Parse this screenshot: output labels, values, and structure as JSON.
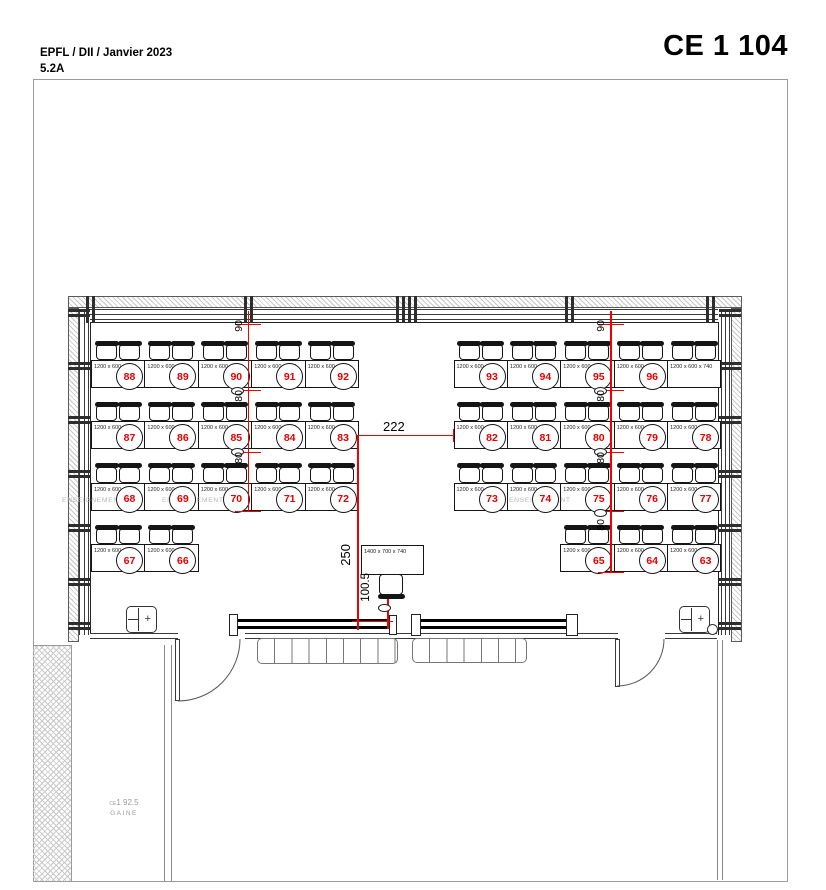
{
  "header": {
    "line1": "EPFL / DII / Janvier 2023",
    "line2": "5.2A",
    "room_title": "CE 1 104"
  },
  "colors": {
    "dimension_red": "#f10000",
    "seat_number_red": "#e60000",
    "zone_grey": "#b9b9b9",
    "wall_hatch_grey": "#c6c6c6"
  },
  "desk_dim_label": "1200 x 600 x 740",
  "teacher_table": {
    "label": "1400 x 700 x 740"
  },
  "seat_rows": [
    {
      "name": "row1-left",
      "desks": [
        "88",
        "89",
        "90",
        "91",
        "92"
      ]
    },
    {
      "name": "row1-right",
      "desks": [
        "93",
        "94",
        "95",
        "96",
        ""
      ]
    },
    {
      "name": "row2-left",
      "desks": [
        "87",
        "86",
        "85",
        "84",
        "83"
      ]
    },
    {
      "name": "row2-right",
      "desks": [
        "82",
        "81",
        "80",
        "79",
        "78"
      ]
    },
    {
      "name": "row3-left",
      "desks": [
        "68",
        "69",
        "70",
        "71",
        "72"
      ]
    },
    {
      "name": "row3-right",
      "desks": [
        "73",
        "74",
        "75",
        "76",
        "77"
      ]
    },
    {
      "name": "row4-left",
      "desks": [
        "67",
        "66"
      ]
    },
    {
      "name": "row4-right",
      "desks": [
        "65",
        "64",
        "63"
      ]
    }
  ],
  "dimensions": {
    "left_column": [
      "90",
      "80",
      "80"
    ],
    "right_column": [
      "90",
      "80",
      "80",
      "80"
    ],
    "aisle": "222",
    "front": "250",
    "board": "100.5"
  },
  "zone_labels": [
    "ENSEIGNEMENT",
    "ENSEIGNEMENT",
    "ENSEIGNEMENT"
  ],
  "shaft": {
    "code_small": "CE",
    "code": "1 92.5",
    "name": "GAINE"
  }
}
